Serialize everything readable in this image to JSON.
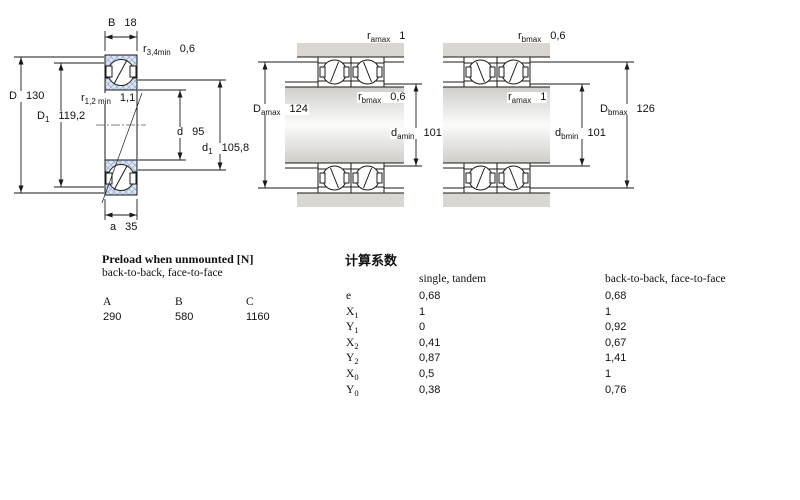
{
  "drawing_labels": {
    "left": {
      "B": {
        "sym": "B",
        "val": "18"
      },
      "r34": {
        "sym": "r",
        "sub": "3,4min",
        "val": "0,6"
      },
      "D": {
        "sym": "D",
        "val": "130"
      },
      "D1": {
        "sym": "D",
        "sub": "1",
        "val": "119,2"
      },
      "r12": {
        "sym": "r",
        "sub": "1,2 min",
        "val": "1,1"
      },
      "d": {
        "sym": "d",
        "val": "95"
      },
      "d1": {
        "sym": "d",
        "sub": "1",
        "val": "105,8"
      },
      "a": {
        "sym": "a",
        "val": "35"
      }
    },
    "middle": {
      "ra_top": {
        "sym": "r",
        "sub": "amax",
        "val": "1"
      },
      "rb": {
        "sym": "r",
        "sub": "bmax",
        "val": "0,6"
      },
      "da": {
        "sym": "d",
        "sub": "amin",
        "val": "101"
      },
      "Da": {
        "sym": "D",
        "sub": "amax",
        "val": "124"
      }
    },
    "right": {
      "rb_top": {
        "sym": "r",
        "sub": "bmax",
        "val": "0,6"
      },
      "ra": {
        "sym": "r",
        "sub": "amax",
        "val": "1"
      },
      "db": {
        "sym": "d",
        "sub": "bmin",
        "val": "101"
      },
      "Db": {
        "sym": "D",
        "sub": "bmax",
        "val": "126"
      }
    }
  },
  "preload_table": {
    "title": "Preload when unmounted [N]",
    "subtitle": "back-to-back, face-to-face",
    "columns": [
      "A",
      "B",
      "C"
    ],
    "values": [
      "290",
      "580",
      "1160"
    ]
  },
  "factors_table": {
    "title": "计算系数",
    "col1_header": "single, tandem",
    "col2_header": "back-to-back, face-to-face",
    "rows": [
      {
        "sym": "e",
        "sub": "",
        "v1": "0,68",
        "v2": "0,68"
      },
      {
        "sym": "X",
        "sub": "1",
        "v1": "1",
        "v2": "1"
      },
      {
        "sym": "Y",
        "sub": "1",
        "v1": "0",
        "v2": "0,92"
      },
      {
        "sym": "X",
        "sub": "2",
        "v1": "0,41",
        "v2": "0,67"
      },
      {
        "sym": "Y",
        "sub": "2",
        "v1": "0,87",
        "v2": "1,41"
      },
      {
        "sym": "X",
        "sub": "0",
        "v1": "0,5",
        "v2": "1"
      },
      {
        "sym": "Y",
        "sub": "0",
        "v1": "0,38",
        "v2": "0,76"
      }
    ]
  },
  "colors": {
    "ring_hatch_bg": "#dce6f3",
    "ring_hatch_line": "#a0b6d8",
    "housing_gray": "#dad7d2",
    "line": "#1a1a1a"
  }
}
